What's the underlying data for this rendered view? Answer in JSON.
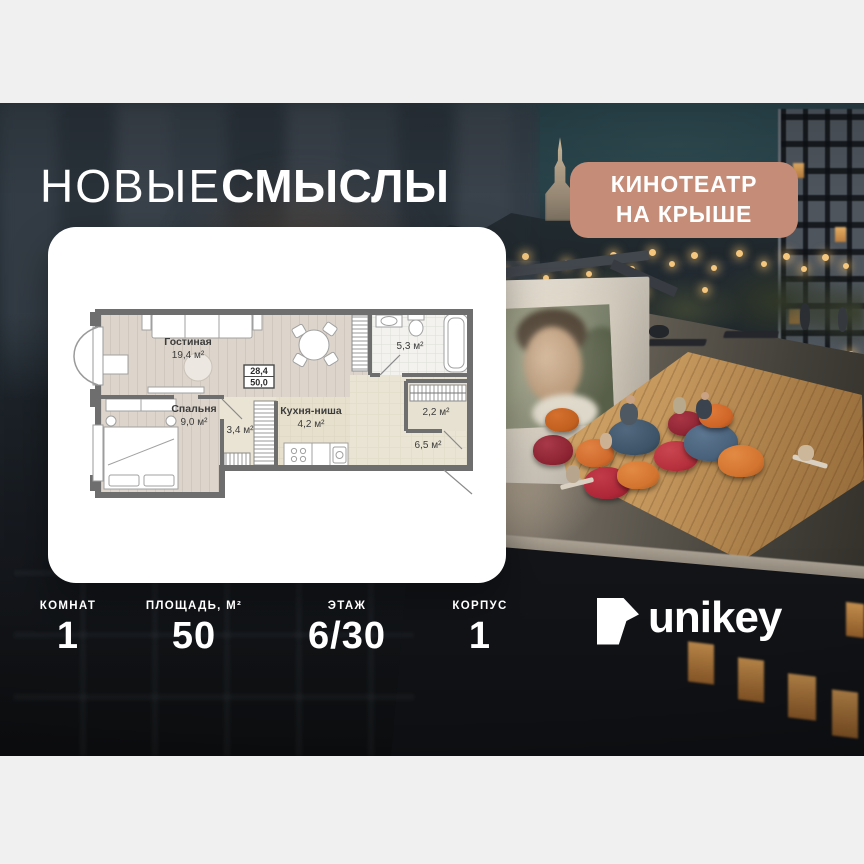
{
  "title": {
    "light": "НОВЫЕ",
    "bold": "СМЫСЛЫ"
  },
  "badge": {
    "line1": "КИНОТЕАТР",
    "line2": "НА КРЫШЕ",
    "bg_color": "#c58c77"
  },
  "plan": {
    "summary": {
      "upper": "28,4",
      "lower": "50,0"
    },
    "rooms": [
      {
        "name": "Гостиная",
        "area": "19,4 м²"
      },
      {
        "name": "Спальня",
        "area": "9,0 м²"
      },
      {
        "name": "",
        "area": "3,4 м²"
      },
      {
        "name": "Кухня-ниша",
        "area": "4,2 м²"
      },
      {
        "name": "",
        "area": "5,3 м²"
      },
      {
        "name": "",
        "area": "2,2 м²"
      },
      {
        "name": "",
        "area": "6,5 м²"
      }
    ]
  },
  "stats": {
    "items": [
      {
        "label": "КОМНАТ",
        "value": "1"
      },
      {
        "label": "ПЛОЩАДЬ, М²",
        "value": "50"
      },
      {
        "label": "ЭТАЖ",
        "value": "6/30"
      },
      {
        "label": "КОРПУС",
        "value": "1"
      }
    ]
  },
  "brand": {
    "name": "unikey"
  },
  "scene": {
    "description": "rooftop cinema at dusk",
    "movie_screen": "man's face projected"
  }
}
